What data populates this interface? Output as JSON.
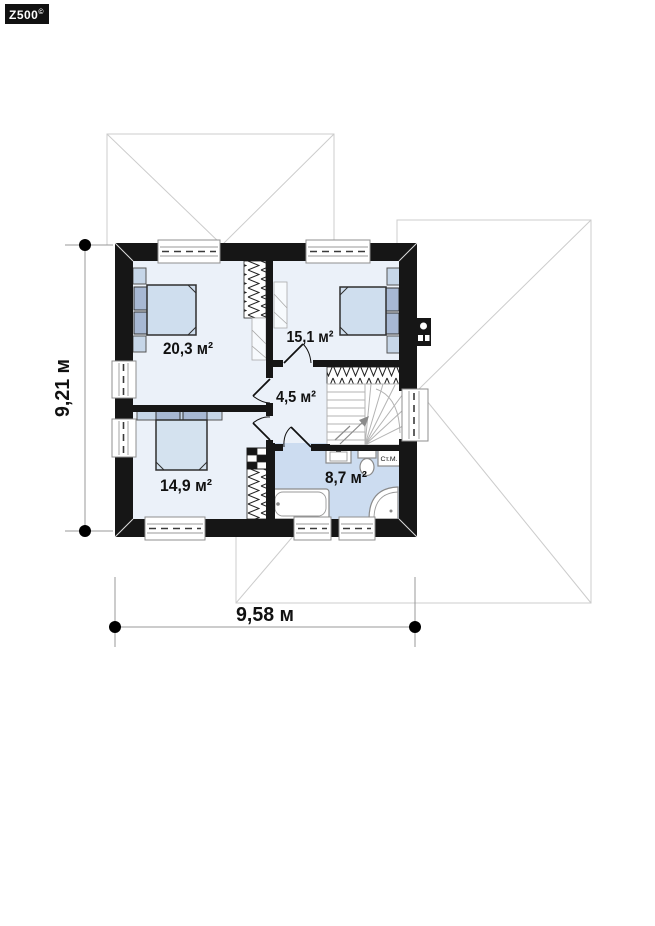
{
  "logo": {
    "text": "Z500",
    "sup": "©"
  },
  "rooms": {
    "bedroom_top_left": {
      "area": "20,3 м²"
    },
    "bedroom_top_right": {
      "area": "15,1 м²"
    },
    "hallway": {
      "area": "4,5 м²"
    },
    "bedroom_bottom_left": {
      "area": "14,9 м²"
    },
    "bathroom": {
      "area": "8,7 м²"
    }
  },
  "appliances": {
    "washing_machine": "Ст.М."
  },
  "dimensions": {
    "width": "9,58 м",
    "height": "9,21 м"
  },
  "colors": {
    "wall": "#161616",
    "room_floor": "#ebf1f9",
    "bathroom_floor": "#ccdcf0",
    "furniture_light": "#cfdeee",
    "furniture_dark": "#a7b8d3",
    "furniture_shelf": "#c6d6e8",
    "roof_line": "#cccccc",
    "dimension_line": "#999999"
  }
}
